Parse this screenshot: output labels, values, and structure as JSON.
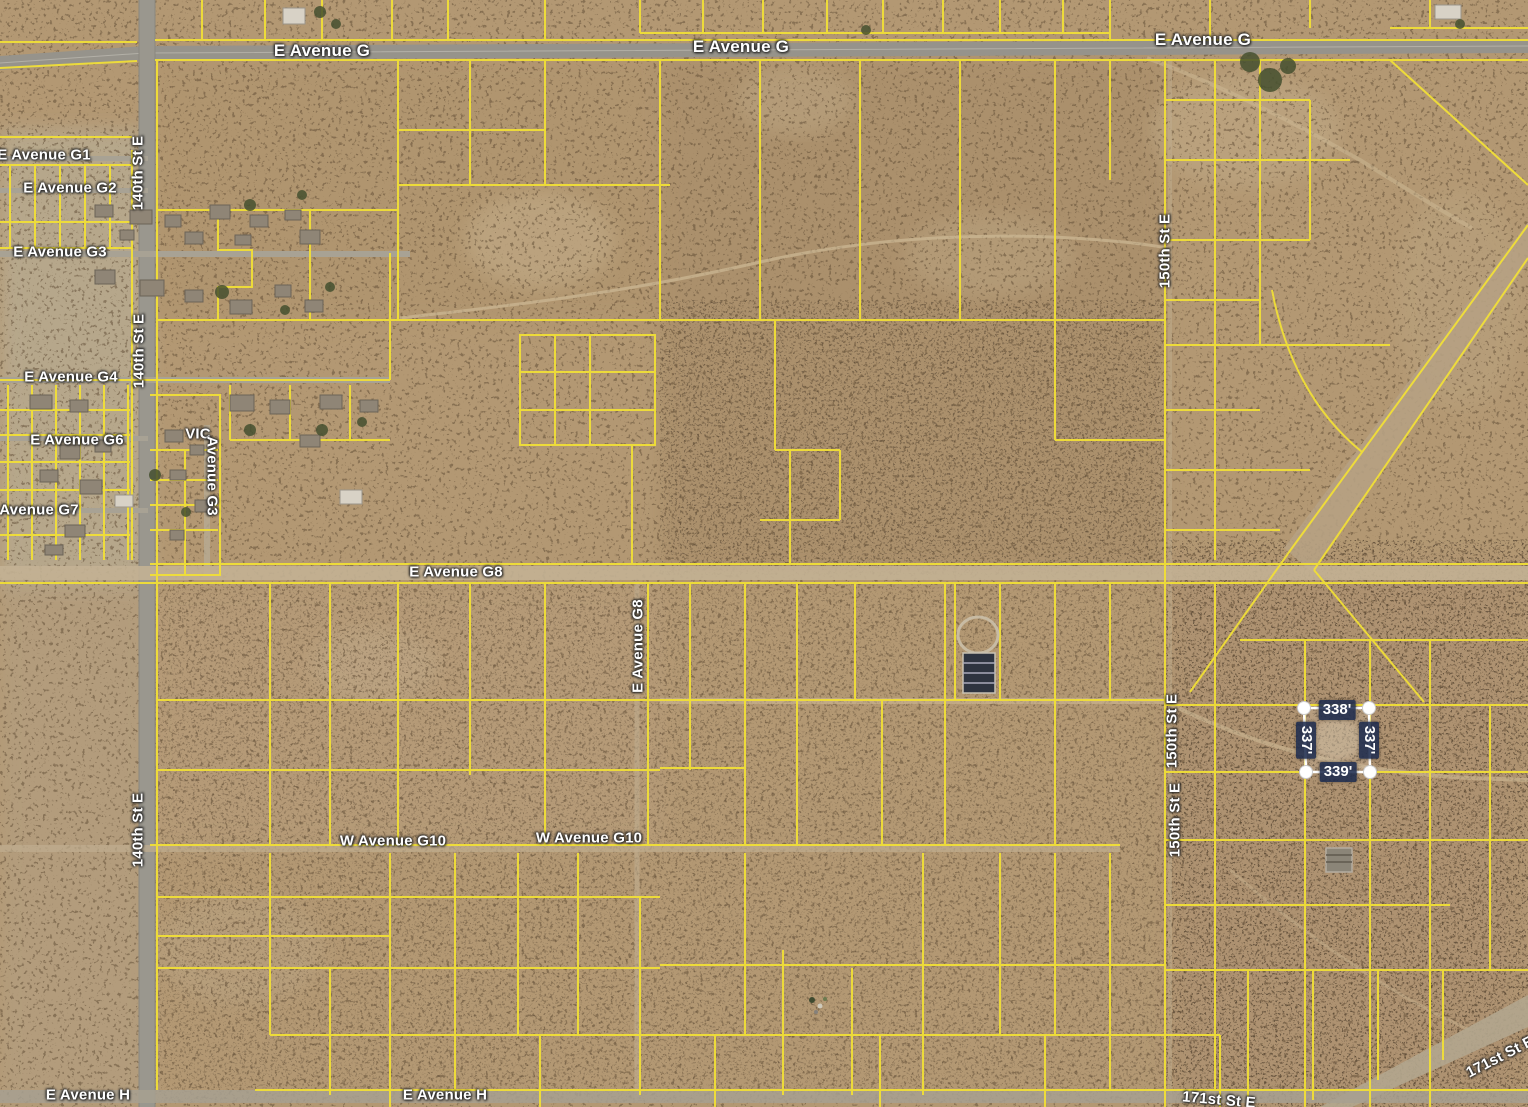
{
  "map": {
    "type": "satellite-parcel-view",
    "colors": {
      "parcel_line": "#f1df37",
      "road_label_color": "#ffffff",
      "measurement_label_bg": "#1e2b4d",
      "selection_handle": "#ffffff",
      "desert_base": "#b39873",
      "paved_road": "#96938b"
    }
  },
  "road_labels": [
    {
      "id": "ave-g-w",
      "text": "E Avenue G"
    },
    {
      "id": "ave-g-c",
      "text": "E Avenue G"
    },
    {
      "id": "ave-g-e",
      "text": "E Avenue G"
    },
    {
      "id": "ave-g1",
      "text": "E Avenue G1"
    },
    {
      "id": "ave-g2",
      "text": "E Avenue G2"
    },
    {
      "id": "ave-g3",
      "text": "E Avenue G3"
    },
    {
      "id": "ave-g4",
      "text": "E Avenue G4"
    },
    {
      "id": "ave-g6",
      "text": "E Avenue G6"
    },
    {
      "id": "ave-g7",
      "text": "Avenue G7"
    },
    {
      "id": "vic",
      "text": "VIC"
    },
    {
      "id": "ave-g3-vert",
      "text": "Avenue G3"
    },
    {
      "id": "st-140-a",
      "text": "140th St E"
    },
    {
      "id": "st-140-b",
      "text": "140th St E"
    },
    {
      "id": "st-140-c",
      "text": "140th St E"
    },
    {
      "id": "st-150-a",
      "text": "150th St E"
    },
    {
      "id": "st-150-b",
      "text": "150th St E"
    },
    {
      "id": "st-150-c",
      "text": "150th St E"
    },
    {
      "id": "ave-g8-h",
      "text": "E Avenue G8"
    },
    {
      "id": "ave-g8-v",
      "text": "E Avenue G8"
    },
    {
      "id": "ave-g10-a",
      "text": "W Avenue G10"
    },
    {
      "id": "ave-g10-b",
      "text": "W Avenue G10"
    },
    {
      "id": "ave-h-a",
      "text": "E Avenue H"
    },
    {
      "id": "ave-h-b",
      "text": "E Avenue H"
    },
    {
      "id": "st-171-diag",
      "text": "171st St E"
    },
    {
      "id": "st-171-bot",
      "text": "171st St E"
    }
  ],
  "measurement": {
    "top": "338'",
    "left": "337'",
    "right": "337'",
    "bottom": "339'"
  }
}
